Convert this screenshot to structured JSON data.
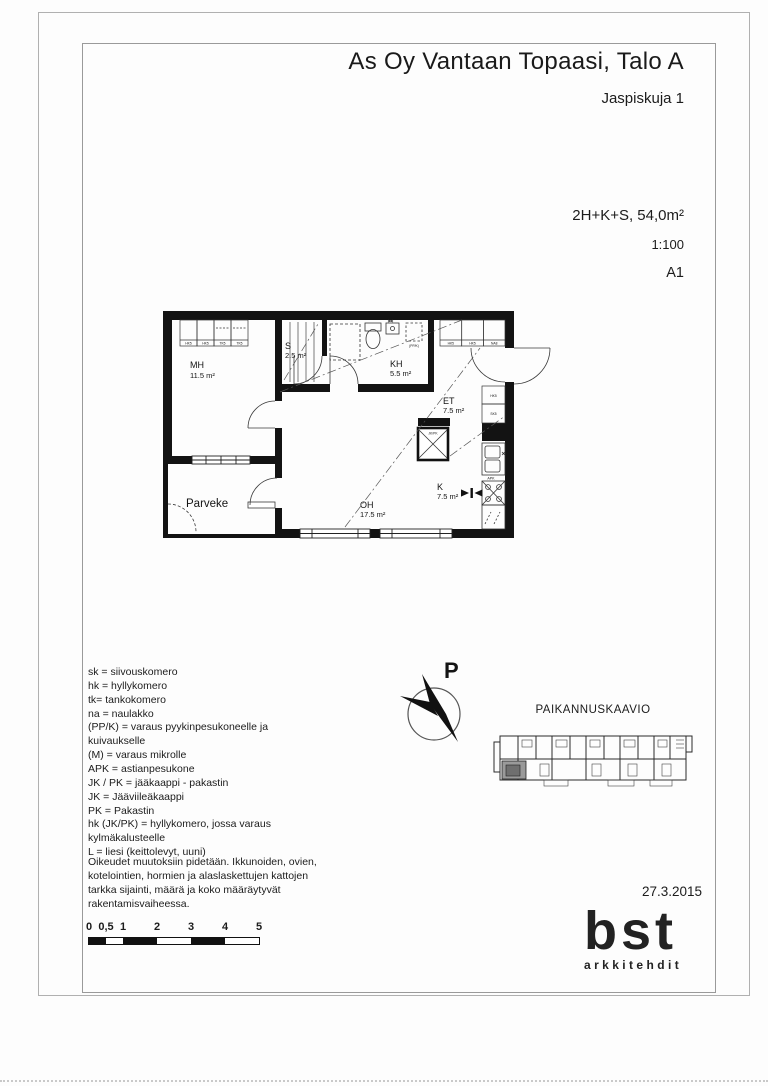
{
  "header": {
    "title": "As Oy Vantaan Topaasi, Talo A",
    "address": "Jaspiskuja 1"
  },
  "drawing_info": {
    "apartment_type": "2H+K+S, 54,0m²",
    "scale": "1:100",
    "sheet": "A1",
    "date": "27.3.2015"
  },
  "floor_plan": {
    "rooms": {
      "mh": {
        "name": "MH",
        "area": "11.5 m²"
      },
      "s": {
        "name": "S",
        "area": "2.5 m²"
      },
      "kh": {
        "name": "KH",
        "area": "5.5 m²"
      },
      "et": {
        "name": "ET",
        "area": "7.5 m²"
      },
      "k": {
        "name": "K",
        "area": "7.5 m²"
      },
      "oh": {
        "name": "OH",
        "area": "17.5 m²"
      },
      "parveke": {
        "name": "Parveke"
      }
    },
    "closets": {
      "mh": [
        "HK5",
        "HK5",
        "TK5",
        "TK5"
      ],
      "et": [
        "HK5",
        "HK5",
        "NA8"
      ],
      "hall": [
        "HK5",
        "SK5"
      ]
    },
    "appliances": {
      "fridge": "JK/PK",
      "dishwasher": "APK",
      "laundry": "(PP/K)"
    }
  },
  "legend": {
    "items": [
      "sk = siivouskomero",
      "hk = hyllykomero",
      "tk= tankokomero",
      "na = naulakko",
      "(PP/K) = varaus pyykinpesukoneelle ja kuivaukselle",
      "(M) = varaus mikrolle",
      "APK = astianpesukone",
      "JK / PK = jääkaappi - pakastin",
      "JK = Jääviileäkaappi",
      "PK = Pakastin",
      "hk (JK/PK) = hyllykomero, jossa varaus kylmäkalusteelle",
      "L = liesi (keittolevyt, uuni)"
    ]
  },
  "disclaimer": "Oikeudet muutoksiin pidetään. Ikkunoiden, ovien, kotelointien, hormien ja alaslaskettujen kattojen tarkka sijainti, määrä ja koko määräytyvät rakentamisvaiheessa.",
  "north_arrow": {
    "label": "P"
  },
  "location_diagram": {
    "title": "PAIKANNUSKAAVIO"
  },
  "scale_bar": {
    "labels": [
      "0",
      "0,5",
      "1",
      "2",
      "3",
      "4",
      "5"
    ]
  },
  "logo": {
    "name": "bst",
    "subtitle": "arkkitehdit"
  }
}
